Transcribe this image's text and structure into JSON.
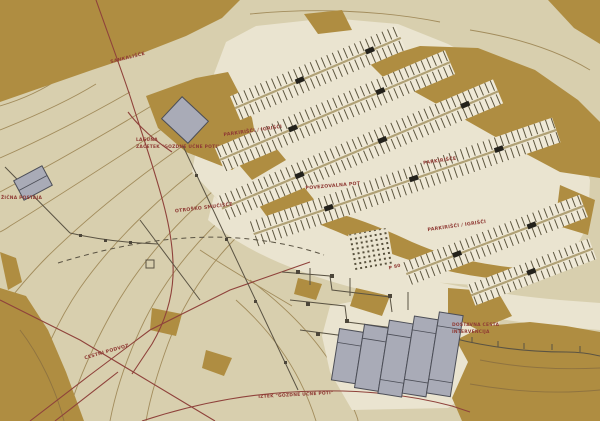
{
  "map": {
    "description": "site plan",
    "labels": {
      "sankalisce": {
        "text": "SANKALIŠČE"
      },
      "laguna": {
        "text": "LAGUNA"
      },
      "laguna_sub": {
        "text": "ZAČETEK \"GOZDNE UČNE POTI\""
      },
      "parking_playgrounds_upper": {
        "text": "PARKIRIŠČI / IGRIŠČI"
      },
      "connecting_path": {
        "text": "POVEZOVALNA POT"
      },
      "parking": {
        "text": "PARKIRIŠČE"
      },
      "parking_playgrounds_right": {
        "text": "PARKIRIŠČI / IGRIŠČI"
      },
      "childrens_ski_slope": {
        "text": "OTROŠKO SMUČIŠČE"
      },
      "lift_station": {
        "text": "ŽIČNA POSTAJA"
      },
      "road_underpass": {
        "text": "CESTNI PODVOZ"
      },
      "delivery_road": {
        "text": "DOSTAVNA CESTA"
      },
      "delivery_road_sub": {
        "text": "INTERVENCIJA"
      },
      "forest_path_end": {
        "text": "IZTEK \"GOZDNE UČNE POTI\""
      },
      "parking_capacity": {
        "text": "P 80"
      }
    },
    "colors": {
      "terrain_base": "#d8cfae",
      "forest": "#af8d41",
      "paved": "#eae4d0",
      "parking_band": "#efe9d7",
      "parking_tick": "#5e5740",
      "contour": "#a28c5c",
      "boundary_red": "#8f423b",
      "label_red": "#8f3a34",
      "building_fill": "#a9abb7",
      "building_stroke": "#4c4e57",
      "mark_black": "#23211b"
    }
  }
}
